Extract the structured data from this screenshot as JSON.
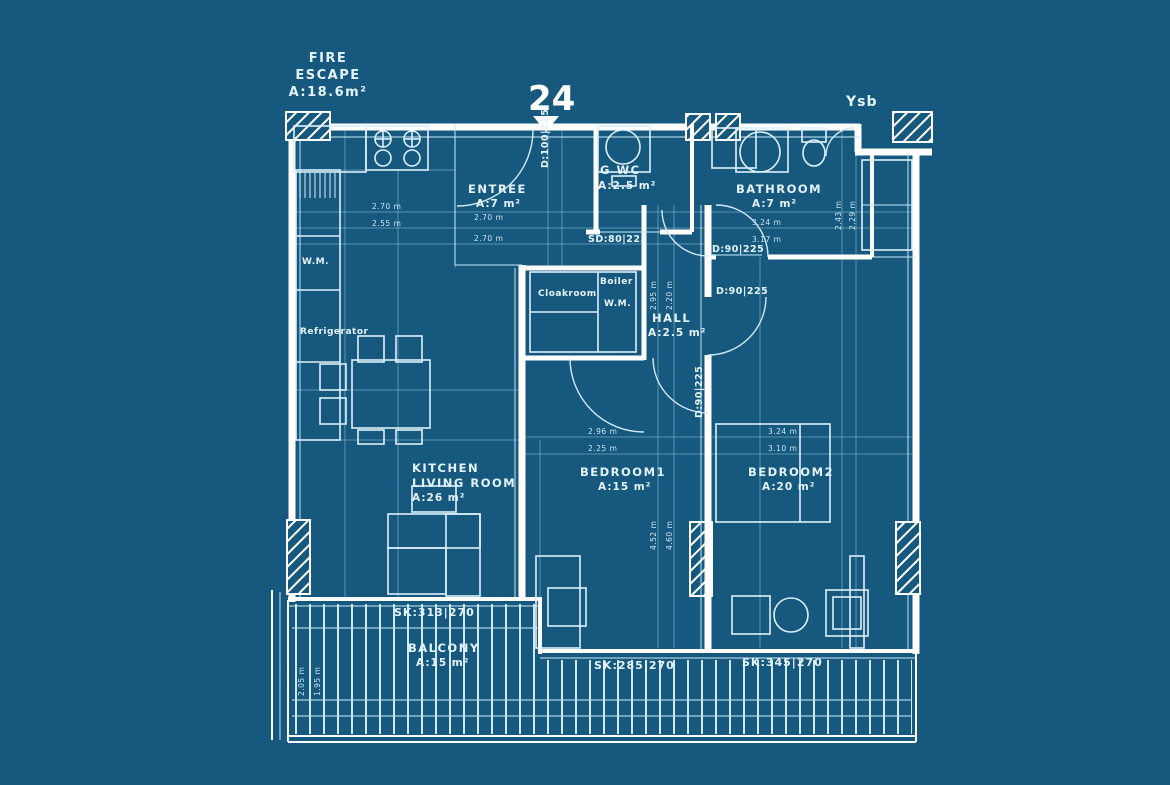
{
  "header": {
    "unit_number": "24",
    "fire_escape_line1": "FIRE",
    "fire_escape_line2": "ESCAPE",
    "fire_escape_area": "A:18.6m²",
    "top_right_label": "Ysb"
  },
  "rooms": {
    "entree": {
      "name": "ENTREE",
      "area": "A:7 m²"
    },
    "guest_wc": {
      "name": "G WC",
      "area": "A:2.5 m²"
    },
    "bathroom": {
      "name": "BATHROOM",
      "area": "A:7 m²"
    },
    "hall": {
      "name": "HALL",
      "area": "A:2.5 m²"
    },
    "kitchen_living": {
      "name_line1": "KITCHEN",
      "name_line2": "LIVING ROOM",
      "area": "A:26 m²"
    },
    "bedroom1": {
      "name": "BEDROOM1",
      "area": "A:15 m²"
    },
    "bedroom2": {
      "name": "BEDROOM2",
      "area": "A:20 m²"
    },
    "balcony": {
      "name": "BALCONY",
      "area": "A:15 m²"
    },
    "cloakroom": {
      "name": "Cloakroom"
    },
    "boiler": {
      "name": "Boiler",
      "appliance": "W.M."
    }
  },
  "appliances": {
    "washing_machine": "W.M.",
    "refrigerator": "Refrigerator"
  },
  "doors": {
    "entry": "D:100|225",
    "wc_sliding": "SD:80|225",
    "bathroom": "D:90|225",
    "bedroom2": "D:90|225",
    "bedroom1": "D:90|225"
  },
  "windows": {
    "balcony_left": "SK:313|270",
    "balcony_mid": "SK:285|270",
    "balcony_right": "SK:345|270"
  },
  "dimensions": {
    "kitchen_w1": "2.70 m",
    "kitchen_w2": "2.55 m",
    "entree_w1": "2.70 m",
    "entree_w2": "2.70 m",
    "bathroom_w1": "3.24 m",
    "bathroom_w2": "3.17 m",
    "bedroom1_w1": "2.96 m",
    "bedroom1_w2": "2.25 m",
    "bedroom2_w1": "3.24 m",
    "bedroom2_w2": "3.10 m",
    "hall_h1": "2.95 m",
    "hall_h2": "2.20 m",
    "bedroom1_h1": "4.52 m",
    "bedroom1_h2": "4.60 m",
    "shaft_h1": "2.43 m",
    "shaft_h2": "2.29 m",
    "balcony_h1": "2.05 m",
    "balcony_h2": "1.95 m"
  },
  "colors": {
    "background": "#17587E",
    "wall": "#FFFFFF",
    "line": "#BFE3F2",
    "text": "#E4F4FC"
  }
}
